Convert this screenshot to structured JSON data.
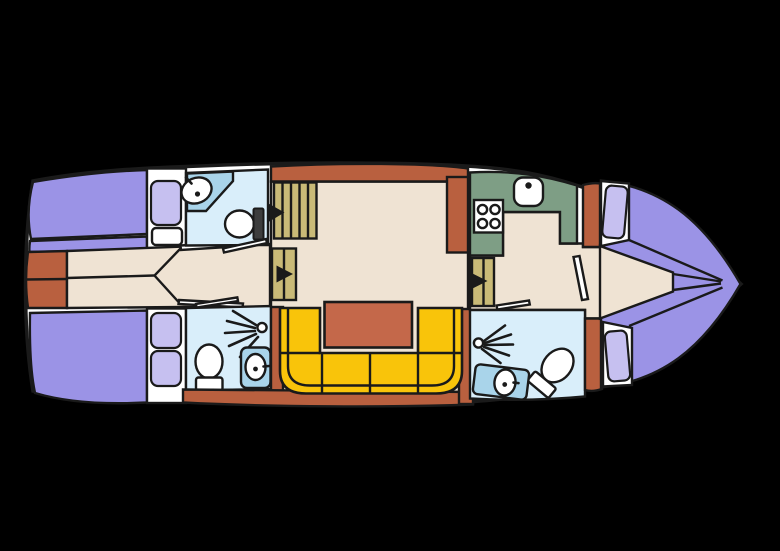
{
  "image": {
    "kind": "boat-floor-plan-diagram",
    "width": 780,
    "height": 551,
    "orientation": "bow-right"
  },
  "palette": {
    "bg": "#000000",
    "hullWhite": "#ffffff",
    "line": "#1a1a1a",
    "berth": "#9b93e6",
    "berthLight": "#c6c0f0",
    "floorBeige": "#efe3d3",
    "wallTerracotta": "#b9603f",
    "tableTerracotta": "#c4684a",
    "sofaYellow": "#f9c40a",
    "galleyGreen": "#7e9e85",
    "bathFloorBlue": "#d9eefa",
    "counterBlue": "#a9d4ea",
    "stepsKhaki": "#c9ba77",
    "fixtureWhite": "#ffffff",
    "tankDark": "#3d3d3d"
  },
  "boat": {
    "areas": [
      {
        "id": "aft-cabin",
        "fixtures": [
          "single-berth",
          "pillow",
          "double-berth",
          "pillow",
          "pillow",
          "wardrobe-shelf",
          "double-door",
          "corridor"
        ]
      },
      {
        "id": "aft-bathroom-top",
        "fixtures": [
          "vanity-counter",
          "sink",
          "toilet",
          "door"
        ]
      },
      {
        "id": "aft-bathroom-bottom",
        "fixtures": [
          "shower-spray",
          "toilet",
          "sink",
          "door"
        ]
      },
      {
        "id": "salon",
        "fixtures": [
          "companionway-steps-with-arrow",
          "steps-with-arrow",
          "u-shaped-sofa",
          "dining-table"
        ]
      },
      {
        "id": "galley",
        "fixtures": [
          "counter",
          "sink",
          "stove-4-burner",
          "steps-with-arrow"
        ]
      },
      {
        "id": "bow-bathroom",
        "fixtures": [
          "shower-spray",
          "vent-fan-unit",
          "toilet",
          "sink",
          "door"
        ]
      },
      {
        "id": "bow-cabin",
        "fixtures": [
          "v-berth-port",
          "v-berth-starboard",
          "pillow",
          "pillow",
          "door"
        ]
      }
    ]
  }
}
